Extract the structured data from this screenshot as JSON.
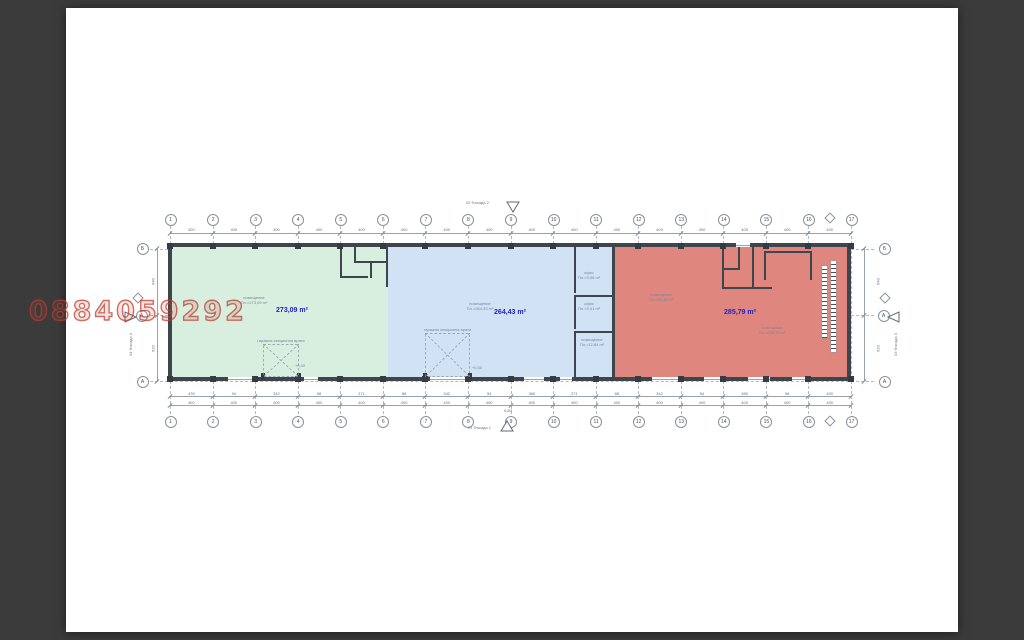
{
  "watermark": {
    "text": "0884059292",
    "color": "#ba3b2e"
  },
  "plan": {
    "grid_numbers": [
      "1",
      "2",
      "3",
      "4",
      "5",
      "6",
      "7",
      "8",
      "9",
      "10",
      "11",
      "12",
      "13",
      "14",
      "15",
      "16",
      "17"
    ],
    "axes": {
      "top": "Б",
      "bottom": "А",
      "section": "А"
    },
    "zones": [
      {
        "caption_name": "помещение",
        "caption_area": "Пл.=273,09 m²",
        "area_label": "273,09 m²",
        "fill": "#d8efdf"
      },
      {
        "caption_name": "помещение",
        "caption_area": "Пл.=264,43 m²",
        "area_label": "264,43 m²",
        "fill": "#d2e2f5"
      },
      {
        "caption_name": "помещение",
        "caption_area": "Пл.=285,79 m²",
        "area_label": "285,79 m²",
        "fill": "#df867e"
      }
    ],
    "rooms": [
      {
        "name": "офис",
        "area": "Пл.=9,06 m²"
      },
      {
        "name": "офис",
        "area": "Пл.=9,01 m²"
      },
      {
        "name": "помещение",
        "area": "Пл.=12,84 m²"
      },
      {
        "name": "помещение",
        "area": "Пл.=36,45 m²"
      }
    ],
    "gates": [
      {
        "label": "гаражна секционна врата"
      },
      {
        "label": "гаражна секционна врата"
      }
    ],
    "facades": [
      {
        "label": "01 Фасада 1"
      },
      {
        "label": "02 Фасада 2"
      },
      {
        "label": "03 Фасада 3"
      },
      {
        "label": "04 Фасада 4"
      }
    ],
    "levels": [
      "+0,00",
      "+0,00"
    ],
    "dims": {
      "top": [
        "400",
        "400",
        "400",
        "400",
        "400",
        "400",
        "400",
        "400",
        "400",
        "400",
        "400",
        "400",
        "400",
        "400",
        "400",
        "400"
      ],
      "bottom_axis": [
        "400",
        "400",
        "400",
        "400",
        "400",
        "400",
        "400",
        "400",
        "400",
        "400",
        "400",
        "400",
        "400",
        "400",
        "400",
        "400"
      ],
      "bottom_openings": [
        "478",
        "94",
        "342",
        "58",
        "271",
        "88",
        "342",
        "54",
        "380",
        "271",
        "88",
        "342",
        "54",
        "380",
        "58",
        "400"
      ],
      "left": [
        "640",
        "620"
      ],
      "right": [
        "640",
        "620"
      ],
      "total_bottom": "6,80"
    },
    "colors": {
      "wall": "#3e464d",
      "grid": "#87919b",
      "area_text": "#2121cd",
      "caption_text": "#7488a0",
      "green_fill": "#d8efdf",
      "blue_fill": "#d2e2f5",
      "red_fill": "#df867e"
    }
  }
}
